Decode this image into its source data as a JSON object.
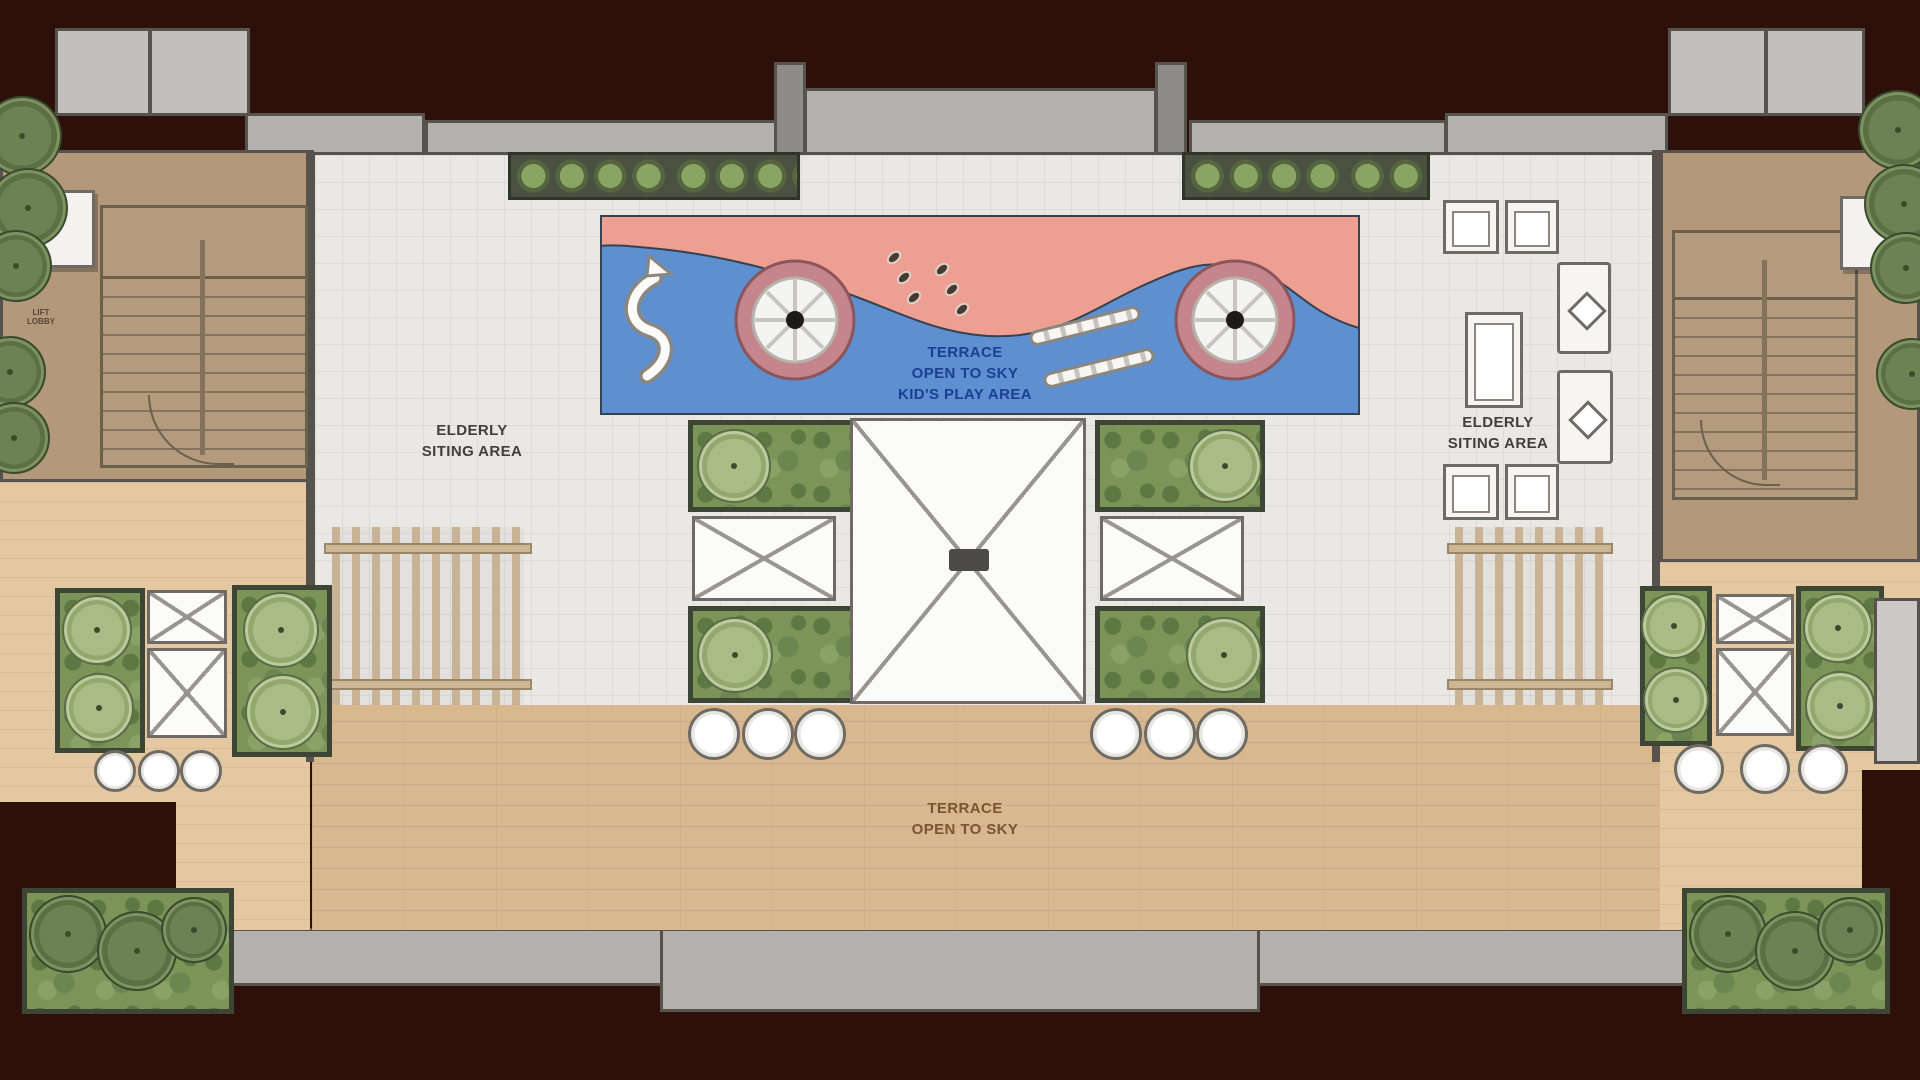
{
  "labels": {
    "kids_play": [
      "TERRACE",
      "OPEN TO SKY",
      "KID'S PLAY AREA"
    ],
    "elderly_left": [
      "ELDERLY",
      "SITING AREA"
    ],
    "elderly_right": [
      "ELDERLY",
      "SITING AREA"
    ],
    "terrace_deck": [
      "TERRACE",
      "OPEN TO SKY"
    ],
    "lift": [
      "LIFT",
      "LOBBY"
    ]
  },
  "colors": {
    "background": "#2c1009",
    "wall": "#57524c",
    "tile_floor": "#e9e8e4",
    "wood_deck": "#d9b88f",
    "wood_deck_light": "#e4c8a2",
    "room_floor": "#b39879",
    "structure_gray": "#b3b1ae",
    "planter_green": "#7d9459",
    "tree_green": "#92a96d",
    "play_mat_pink": "#ef9f92",
    "play_mat_blue": "#5e8fd0",
    "merry_go_round_ring": "#c4868c",
    "play_text_blue": "#1c3e93",
    "label_gray": "#3f3f3f",
    "label_brown": "#7b5431"
  }
}
